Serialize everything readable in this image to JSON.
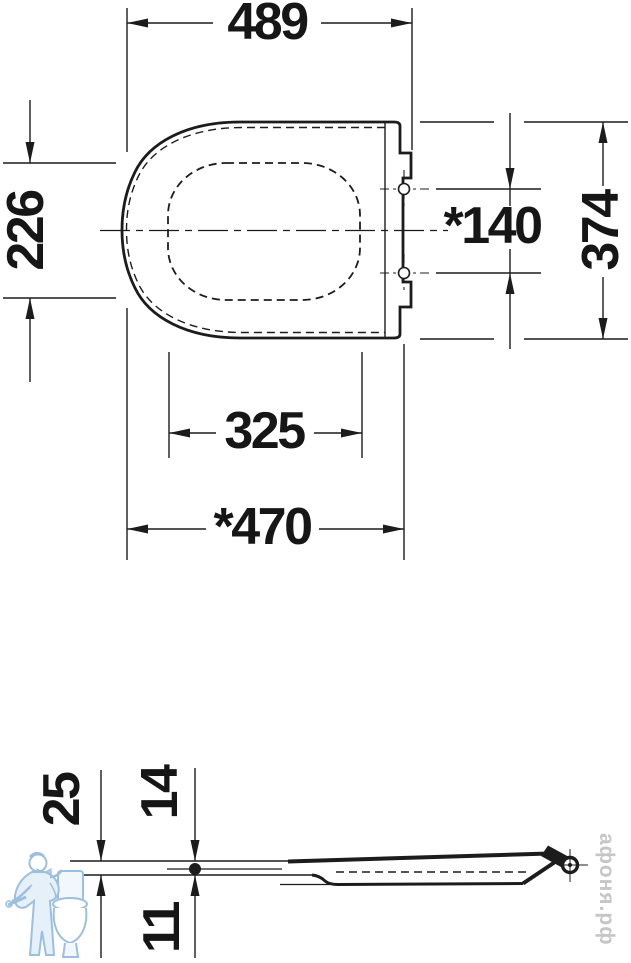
{
  "drawing": {
    "type": "technical-dimension-drawing",
    "subject": "toilet-seat",
    "views": [
      "top-view",
      "side-view"
    ]
  },
  "top_view": {
    "dims": {
      "overall_width": "489",
      "opening_depth": "226",
      "hinge_spacing": "*140",
      "overall_depth": "374",
      "opening_width": "325",
      "seat_length": "*470"
    }
  },
  "side_view": {
    "dims": {
      "total_height": "25",
      "upper_height": "14",
      "lower_height": "11"
    }
  },
  "watermark": {
    "text": "афоня.рф"
  },
  "icons": {
    "logo": "plumber-with-toilet-logo"
  },
  "colors": {
    "line": "#1c1c1c",
    "text": "#161616",
    "watermark_text": "#c6c6c6",
    "logo_blue": "#9cbfdf",
    "background": "#ffffff"
  }
}
